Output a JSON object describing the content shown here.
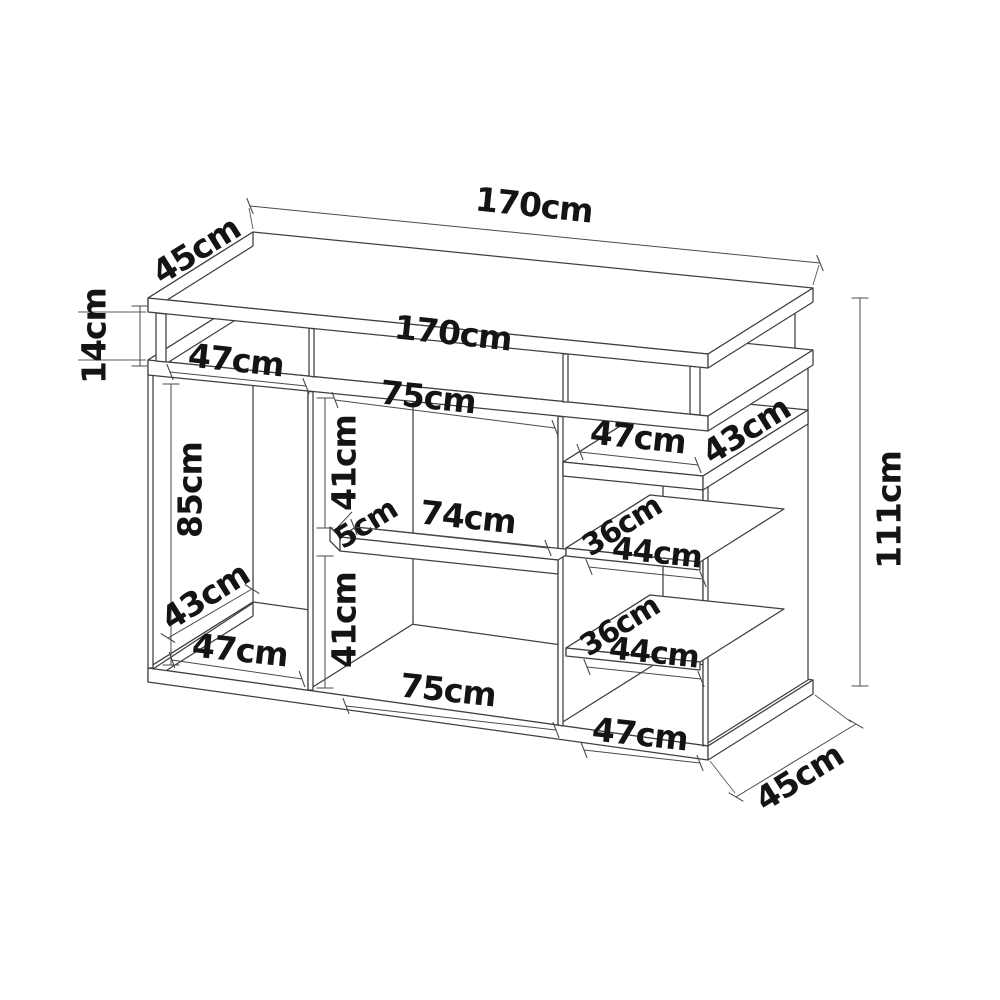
{
  "diagram": {
    "type": "oblique-furniture-dimension-drawing",
    "unit": "cm",
    "colors": {
      "background": "#ffffff",
      "structure_line": "#3f3f3f",
      "dimension_line": "#4a4a4a",
      "text": "#141414"
    },
    "dimensions": [
      {
        "name": "overall-width",
        "text": "170cm",
        "x": 534,
        "y": 205,
        "rot": 6,
        "size": 33,
        "line": {
          "x1": 250,
          "y1": 206,
          "x2": 820,
          "y2": 263
        },
        "tick": "slash"
      },
      {
        "name": "top-depth",
        "text": "45cm",
        "x": 196,
        "y": 250,
        "rot": -32,
        "size": 33,
        "line": null,
        "tick": "none"
      },
      {
        "name": "top-gap-height",
        "text": "14cm",
        "x": 94,
        "y": 336,
        "rot": -90,
        "size": 33,
        "line": {
          "x1": 140,
          "y1": 306,
          "x2": 140,
          "y2": 366
        },
        "tick": "perp"
      },
      {
        "name": "carcass-top-width",
        "text": "170cm",
        "x": 453,
        "y": 333,
        "rot": 6,
        "size": 33,
        "line": null,
        "tick": "none"
      },
      {
        "name": "top-left-opening-width",
        "text": "47cm",
        "x": 236,
        "y": 360,
        "rot": 6,
        "size": 33,
        "line": {
          "x1": 170,
          "y1": 372,
          "x2": 306,
          "y2": 386
        },
        "tick": "slash"
      },
      {
        "name": "top-middle-opening-width",
        "text": "75cm",
        "x": 428,
        "y": 397,
        "rot": 6,
        "size": 33,
        "line": {
          "x1": 335,
          "y1": 400,
          "x2": 555,
          "y2": 428
        },
        "tick": "slash"
      },
      {
        "name": "right-opening-width",
        "text": "47cm",
        "x": 638,
        "y": 437,
        "rot": 6,
        "size": 33,
        "line": {
          "x1": 580,
          "y1": 452,
          "x2": 698,
          "y2": 465
        },
        "tick": "slash"
      },
      {
        "name": "right-top-shelf-depth",
        "text": "43cm",
        "x": 746,
        "y": 430,
        "rot": -32,
        "size": 33,
        "line": null,
        "tick": "none"
      },
      {
        "name": "overall-height",
        "text": "111cm",
        "x": 889,
        "y": 510,
        "rot": -90,
        "size": 33,
        "line": {
          "x1": 860,
          "y1": 298,
          "x2": 860,
          "y2": 686
        },
        "tick": "perp"
      },
      {
        "name": "left-opening-height",
        "text": "85cm",
        "x": 190,
        "y": 490,
        "rot": -90,
        "size": 33,
        "line": {
          "x1": 171,
          "y1": 384,
          "x2": 171,
          "y2": 665
        },
        "tick": "perp"
      },
      {
        "name": "middle-upper-height",
        "text": "41cm",
        "x": 344,
        "y": 463,
        "rot": -90,
        "size": 33,
        "line": {
          "x1": 325,
          "y1": 398,
          "x2": 325,
          "y2": 528
        },
        "tick": "perp"
      },
      {
        "name": "shelf-thickness",
        "text": "5cm",
        "x": 366,
        "y": 524,
        "rot": -32,
        "size": 30,
        "line": {
          "x1": 352,
          "y1": 512,
          "x2": 335,
          "y2": 530
        },
        "tick": "none"
      },
      {
        "name": "middle-shelf-width",
        "text": "74cm",
        "x": 468,
        "y": 517,
        "rot": 6,
        "size": 33,
        "line": {
          "x1": 354,
          "y1": 527,
          "x2": 548,
          "y2": 548
        },
        "tick": "slash"
      },
      {
        "name": "middle-lower-height",
        "text": "41cm",
        "x": 344,
        "y": 620,
        "rot": -90,
        "size": 33,
        "line": {
          "x1": 325,
          "y1": 556,
          "x2": 325,
          "y2": 688
        },
        "tick": "perp"
      },
      {
        "name": "floor-depth",
        "text": "43cm",
        "x": 205,
        "y": 596,
        "rot": -32,
        "size": 33,
        "line": {
          "x1": 168,
          "y1": 638,
          "x2": 252,
          "y2": 589
        },
        "tick": "slash"
      },
      {
        "name": "floor-left-width",
        "text": "47cm",
        "x": 240,
        "y": 650,
        "rot": 6,
        "size": 33,
        "line": {
          "x1": 172,
          "y1": 660,
          "x2": 302,
          "y2": 679
        },
        "tick": "slash"
      },
      {
        "name": "upper-shelf-depth",
        "text": "36cm",
        "x": 622,
        "y": 526,
        "rot": -32,
        "size": 30,
        "line": null,
        "tick": "none"
      },
      {
        "name": "upper-shelf-width",
        "text": "44cm",
        "x": 657,
        "y": 553,
        "rot": 6,
        "size": 31,
        "line": {
          "x1": 589,
          "y1": 567,
          "x2": 703,
          "y2": 579
        },
        "tick": "slash"
      },
      {
        "name": "lower-shelf-depth",
        "text": "36cm",
        "x": 620,
        "y": 626,
        "rot": -32,
        "size": 30,
        "line": null,
        "tick": "none"
      },
      {
        "name": "lower-shelf-width",
        "text": "44cm",
        "x": 654,
        "y": 653,
        "rot": 6,
        "size": 31,
        "line": {
          "x1": 587,
          "y1": 667,
          "x2": 701,
          "y2": 679
        },
        "tick": "slash"
      },
      {
        "name": "floor-middle-width",
        "text": "75cm",
        "x": 448,
        "y": 690,
        "rot": 6,
        "size": 33,
        "line": {
          "x1": 346,
          "y1": 706,
          "x2": 556,
          "y2": 730
        },
        "tick": "slash"
      },
      {
        "name": "floor-right-width",
        "text": "47cm",
        "x": 640,
        "y": 734,
        "rot": 6,
        "size": 33,
        "line": {
          "x1": 584,
          "y1": 750,
          "x2": 700,
          "y2": 763
        },
        "tick": "slash"
      },
      {
        "name": "bottom-depth",
        "text": "45cm",
        "x": 799,
        "y": 777,
        "rot": -32,
        "size": 33,
        "line": {
          "x1": 736,
          "y1": 797,
          "x2": 856,
          "y2": 724
        },
        "tick": "slash"
      }
    ]
  }
}
